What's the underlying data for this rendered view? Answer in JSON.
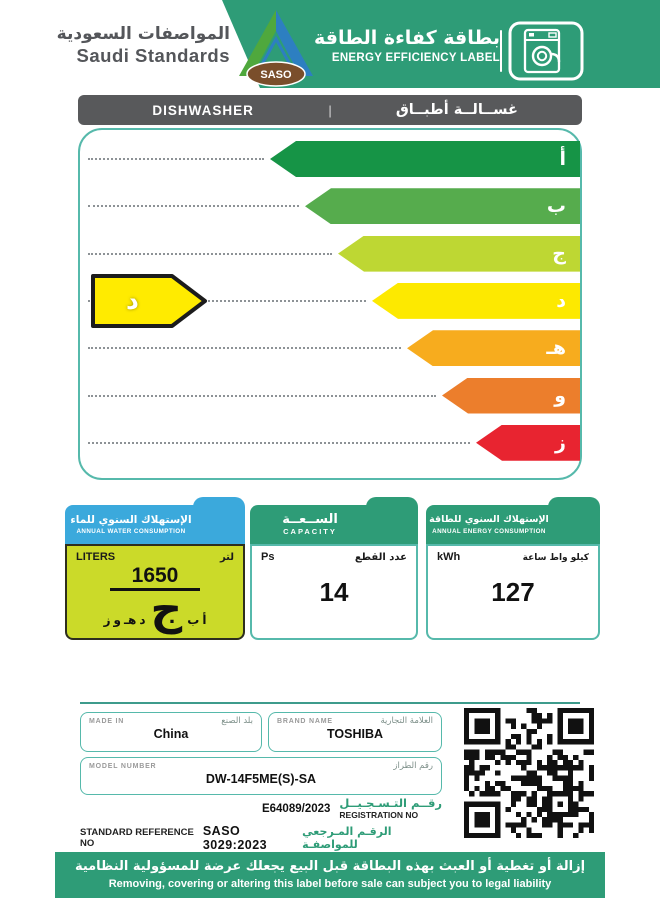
{
  "header": {
    "org_ar": "المواصفات السعودية",
    "org_en": "Saudi Standards",
    "saso": "SASO",
    "title_ar": "بطاقة كفاءة الطاقة",
    "title_en": "ENERGY EFFICIENCY LABEL"
  },
  "product": {
    "en": "DISHWASHER",
    "divider": "|",
    "ar": "غســالــة أطبــاق"
  },
  "rating": {
    "selected": "د",
    "grades": [
      {
        "letter": "أ",
        "color": "#169446",
        "width": 310
      },
      {
        "letter": "ب",
        "color": "#56AC4D",
        "width": 275
      },
      {
        "letter": "ج",
        "color": "#BED733",
        "width": 242
      },
      {
        "letter": "د",
        "color": "#FDE900",
        "width": 208
      },
      {
        "letter": "هـ",
        "color": "#F7AC1E",
        "width": 173
      },
      {
        "letter": "و",
        "color": "#EC7E2C",
        "width": 138
      },
      {
        "letter": "ز",
        "color": "#E82430",
        "width": 104
      }
    ]
  },
  "water": {
    "title_ar": "الإستهلاك السنوي للماء",
    "title_en": "ANNUAL WATER CONSUMPTION",
    "unit_en": "LITERS",
    "unit_ar": "لتر",
    "value": "1650",
    "grade": "ج",
    "scale": [
      "أ",
      "ب",
      "ج",
      "د",
      "هـ",
      "و",
      "ز"
    ]
  },
  "capacity": {
    "title_ar": "الســعــة",
    "title_en": "CAPACITY",
    "unit_en": "Ps",
    "unit_ar": "عدد القطع",
    "value": "14"
  },
  "energy": {
    "title_ar": "الإستهلاك السنوي للطاقة",
    "title_en": "ANNUAL ENERGY CONSUMPTION",
    "unit_en": "kWh",
    "unit_ar": "كيلو واط ساعة",
    "value": "127"
  },
  "details": {
    "made_in": {
      "label_en": "MADE IN",
      "label_ar": "بلد الصنع",
      "value": "China"
    },
    "brand": {
      "label_en": "BRAND NAME",
      "label_ar": "العلامة التجارية",
      "value": "TOSHIBA"
    },
    "model": {
      "label_en": "MODEL NUMBER",
      "label_ar": "رقم الطراز",
      "value": "DW-14F5ME(S)-SA"
    },
    "registration": {
      "value": "E64089/2023",
      "label_ar": "رقــم التـسـجـيــل",
      "label_en": "REGISTRATION NO"
    },
    "standard": {
      "label_en": "STANDARD REFERENCE NO",
      "value": "SASO 3029:2023",
      "label_ar": "الرقـم المـرجعي للمواصفـة"
    }
  },
  "footer": {
    "ar": "إزالة أو تغطية أو العبث بهذه البطاقة قبل البيع يجعلك عرضة للمسؤولية النظامية",
    "en": "Removing, covering or altering this label before sale can subject you to legal liability"
  },
  "colors": {
    "brand_green": "#2E9C77",
    "water_blue": "#3BA9DC",
    "water_body": "#CBDA29",
    "bar_gray": "#58595B",
    "chart_border": "#56B9AB"
  }
}
